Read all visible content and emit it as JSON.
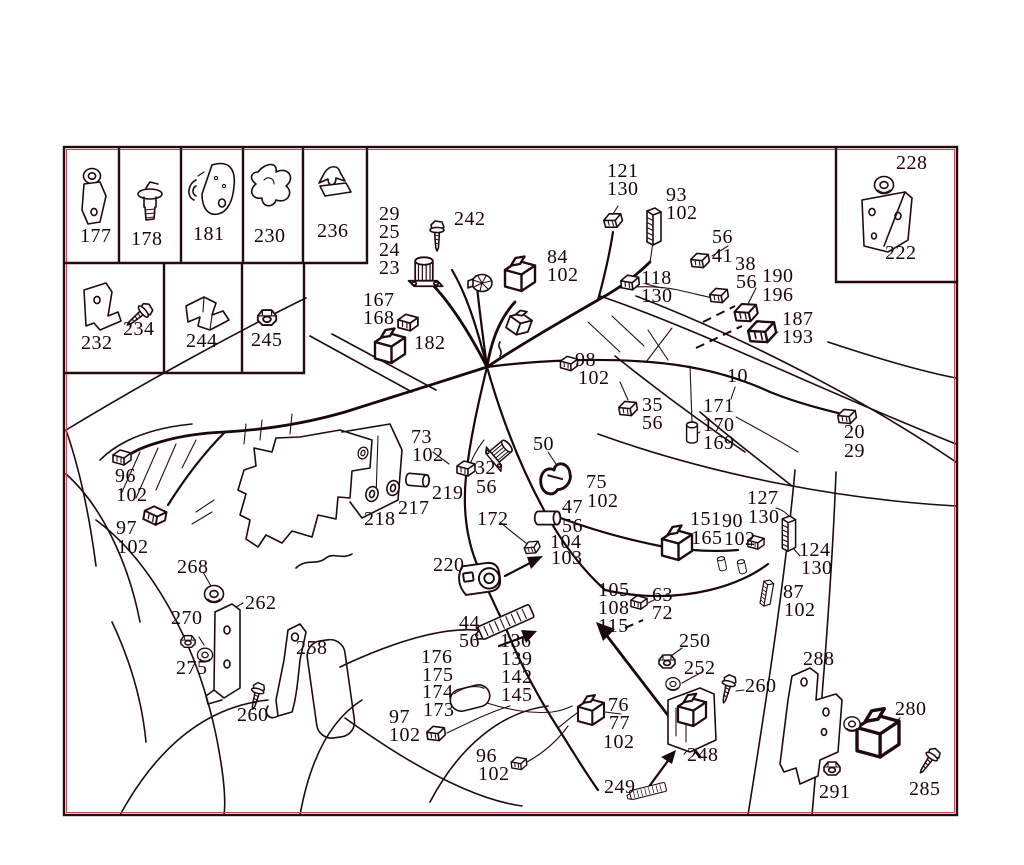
{
  "title": "engine wiring harness parts diagram",
  "colors": {
    "background": "#ffffff",
    "ink": "#200a0e",
    "accent_fringe": "#d24055",
    "label": "#1c0609"
  },
  "inset_rows": {
    "row1": [
      "177",
      "178",
      "181",
      "230",
      "236"
    ],
    "row2": [
      "232",
      "234",
      "244",
      "245"
    ],
    "top_right": [
      "228",
      "222"
    ]
  },
  "callouts": [
    {
      "t": "177",
      "x": 80,
      "y": 229
    },
    {
      "t": "178",
      "x": 131,
      "y": 232
    },
    {
      "t": "181",
      "x": 193,
      "y": 227
    },
    {
      "t": "230",
      "x": 254,
      "y": 229
    },
    {
      "t": "236",
      "x": 317,
      "y": 224
    },
    {
      "t": "232",
      "x": 81,
      "y": 336
    },
    {
      "t": "234",
      "x": 123,
      "y": 322
    },
    {
      "t": "244",
      "x": 186,
      "y": 334
    },
    {
      "t": "245",
      "x": 251,
      "y": 333
    },
    {
      "t": "228",
      "x": 896,
      "y": 156
    },
    {
      "t": "222",
      "x": 885,
      "y": 246
    },
    {
      "t": "29",
      "x": 379,
      "y": 207
    },
    {
      "t": "25",
      "x": 379,
      "y": 225
    },
    {
      "t": "24",
      "x": 379,
      "y": 243
    },
    {
      "t": "23",
      "x": 379,
      "y": 261
    },
    {
      "t": "242",
      "x": 454,
      "y": 212
    },
    {
      "t": "84",
      "x": 547,
      "y": 250
    },
    {
      "t": "102",
      "x": 547,
      "y": 268
    },
    {
      "t": "167",
      "x": 363,
      "y": 293
    },
    {
      "t": "168",
      "x": 363,
      "y": 311
    },
    {
      "t": "182",
      "x": 414,
      "y": 336
    },
    {
      "t": "98",
      "x": 575,
      "y": 353
    },
    {
      "t": "102",
      "x": 578,
      "y": 371
    },
    {
      "t": "121",
      "x": 607,
      "y": 164
    },
    {
      "t": "130",
      "x": 607,
      "y": 182
    },
    {
      "t": "93",
      "x": 666,
      "y": 188
    },
    {
      "t": "102",
      "x": 666,
      "y": 206
    },
    {
      "t": "56",
      "x": 712,
      "y": 230
    },
    {
      "t": "41",
      "x": 712,
      "y": 249
    },
    {
      "t": "38",
      "x": 735,
      "y": 257
    },
    {
      "t": "56",
      "x": 736,
      "y": 275
    },
    {
      "t": "190",
      "x": 762,
      "y": 269
    },
    {
      "t": "196",
      "x": 762,
      "y": 288
    },
    {
      "t": "187",
      "x": 782,
      "y": 312
    },
    {
      "t": "193",
      "x": 782,
      "y": 330
    },
    {
      "t": "118",
      "x": 641,
      "y": 271
    },
    {
      "t": "130",
      "x": 641,
      "y": 289
    },
    {
      "t": "10",
      "x": 727,
      "y": 369
    },
    {
      "t": "35",
      "x": 642,
      "y": 398
    },
    {
      "t": "56",
      "x": 642,
      "y": 416
    },
    {
      "t": "171",
      "x": 703,
      "y": 399
    },
    {
      "t": "170",
      "x": 703,
      "y": 418
    },
    {
      "t": "169",
      "x": 703,
      "y": 436
    },
    {
      "t": "20",
      "x": 844,
      "y": 425
    },
    {
      "t": "29",
      "x": 844,
      "y": 444
    },
    {
      "t": "96",
      "x": 115,
      "y": 469
    },
    {
      "t": "102",
      "x": 116,
      "y": 488
    },
    {
      "t": "97",
      "x": 116,
      "y": 521
    },
    {
      "t": "102",
      "x": 117,
      "y": 540
    },
    {
      "t": "73",
      "x": 411,
      "y": 430
    },
    {
      "t": "102",
      "x": 412,
      "y": 448
    },
    {
      "t": "32",
      "x": 475,
      "y": 461
    },
    {
      "t": "56",
      "x": 476,
      "y": 480
    },
    {
      "t": "50",
      "x": 533,
      "y": 437
    },
    {
      "t": "219",
      "x": 432,
      "y": 486
    },
    {
      "t": "217",
      "x": 398,
      "y": 501
    },
    {
      "t": "218",
      "x": 364,
      "y": 512
    },
    {
      "t": "75",
      "x": 586,
      "y": 475
    },
    {
      "t": "102",
      "x": 587,
      "y": 494
    },
    {
      "t": "47",
      "x": 562,
      "y": 500
    },
    {
      "t": "56",
      "x": 562,
      "y": 519
    },
    {
      "t": "104",
      "x": 550,
      "y": 535
    },
    {
      "t": "103",
      "x": 551,
      "y": 551
    },
    {
      "t": "172",
      "x": 477,
      "y": 512
    },
    {
      "t": "220",
      "x": 433,
      "y": 558
    },
    {
      "t": "127",
      "x": 747,
      "y": 491
    },
    {
      "t": "130",
      "x": 748,
      "y": 510
    },
    {
      "t": "151",
      "x": 690,
      "y": 512
    },
    {
      "t": "165",
      "x": 691,
      "y": 531
    },
    {
      "t": "90",
      "x": 722,
      "y": 514
    },
    {
      "t": "102",
      "x": 724,
      "y": 532
    },
    {
      "t": "124",
      "x": 799,
      "y": 543
    },
    {
      "t": "130",
      "x": 801,
      "y": 561
    },
    {
      "t": "87",
      "x": 783,
      "y": 585
    },
    {
      "t": "102",
      "x": 784,
      "y": 603
    },
    {
      "t": "63",
      "x": 652,
      "y": 588
    },
    {
      "t": "72",
      "x": 652,
      "y": 606
    },
    {
      "t": "105",
      "x": 598,
      "y": 583
    },
    {
      "t": "108",
      "x": 598,
      "y": 601
    },
    {
      "t": "115",
      "x": 598,
      "y": 619
    },
    {
      "t": "268",
      "x": 177,
      "y": 560
    },
    {
      "t": "262",
      "x": 245,
      "y": 596
    },
    {
      "t": "270",
      "x": 171,
      "y": 611
    },
    {
      "t": "275",
      "x": 176,
      "y": 661
    },
    {
      "t": "258",
      "x": 296,
      "y": 641
    },
    {
      "t": "260",
      "x": 237,
      "y": 708
    },
    {
      "t": "44",
      "x": 459,
      "y": 616
    },
    {
      "t": "56",
      "x": 459,
      "y": 634
    },
    {
      "t": "136",
      "x": 500,
      "y": 634
    },
    {
      "t": "139",
      "x": 501,
      "y": 652
    },
    {
      "t": "142",
      "x": 501,
      "y": 670
    },
    {
      "t": "145",
      "x": 501,
      "y": 688
    },
    {
      "t": "176",
      "x": 421,
      "y": 650
    },
    {
      "t": "175",
      "x": 422,
      "y": 668
    },
    {
      "t": "174",
      "x": 422,
      "y": 685
    },
    {
      "t": "173",
      "x": 423,
      "y": 703
    },
    {
      "t": "97",
      "x": 389,
      "y": 710
    },
    {
      "t": "102",
      "x": 389,
      "y": 728
    },
    {
      "t": "96",
      "x": 476,
      "y": 749
    },
    {
      "t": "102",
      "x": 478,
      "y": 767
    },
    {
      "t": "76",
      "x": 608,
      "y": 698
    },
    {
      "t": "77",
      "x": 609,
      "y": 716
    },
    {
      "t": "102",
      "x": 603,
      "y": 735
    },
    {
      "t": "249",
      "x": 604,
      "y": 780
    },
    {
      "t": "248",
      "x": 687,
      "y": 748
    },
    {
      "t": "250",
      "x": 679,
      "y": 634
    },
    {
      "t": "252",
      "x": 684,
      "y": 661
    },
    {
      "t": "260",
      "x": 745,
      "y": 679
    },
    {
      "t": "288",
      "x": 803,
      "y": 652
    },
    {
      "t": "280",
      "x": 895,
      "y": 702
    },
    {
      "t": "291",
      "x": 819,
      "y": 785
    },
    {
      "t": "285",
      "x": 909,
      "y": 782
    }
  ],
  "parts": [
    {
      "n": "connector-121",
      "s": "conn",
      "x": 613,
      "y": 220,
      "r": -15
    },
    {
      "n": "connector-block-93",
      "s": "tall",
      "x": 653,
      "y": 228,
      "r": 0
    },
    {
      "n": "connector-56-41",
      "s": "conn",
      "x": 700,
      "y": 260,
      "r": -10
    },
    {
      "n": "connector-118-130",
      "s": "conn",
      "x": 630,
      "y": 282,
      "r": -5
    },
    {
      "n": "connector-38-56",
      "s": "conn",
      "x": 719,
      "y": 295,
      "r": -10
    },
    {
      "n": "connector-190-196",
      "s": "conn",
      "x": 746,
      "y": 312,
      "r": -12,
      "sc": 1.25
    },
    {
      "n": "connector-187-193",
      "s": "conn",
      "x": 762,
      "y": 331,
      "r": -12,
      "sc": 1.5
    },
    {
      "n": "relay-84",
      "s": "relay",
      "x": 520,
      "y": 276,
      "sc": 1.5
    },
    {
      "n": "canister-29-23",
      "s": "can",
      "x": 424,
      "y": 272,
      "sc": 1.1
    },
    {
      "n": "screw-242",
      "s": "screw",
      "x": 437,
      "y": 237
    },
    {
      "n": "fan-disc",
      "s": "fan",
      "x": 482,
      "y": 283
    },
    {
      "n": "connector-167-168",
      "s": "conn",
      "x": 408,
      "y": 322,
      "sc": 1.1
    },
    {
      "n": "relay-182",
      "s": "relay",
      "x": 390,
      "y": 348,
      "sc": 1.5
    },
    {
      "n": "sensor-hub",
      "s": "relay",
      "x": 519,
      "y": 324,
      "r": 20,
      "sc": 1.1
    },
    {
      "n": "connector-98",
      "s": "conn",
      "x": 569,
      "y": 363,
      "sc": 0.95
    },
    {
      "n": "connector-35-56",
      "s": "conn",
      "x": 628,
      "y": 408,
      "r": -10
    },
    {
      "n": "cylinder-171-169",
      "s": "cyl",
      "x": 692,
      "y": 433,
      "sc": 0.9
    },
    {
      "n": "connector-20-29",
      "s": "conn",
      "x": 847,
      "y": 416,
      "r": -10
    },
    {
      "n": "connector-96-102-top",
      "s": "conn",
      "x": 122,
      "y": 457,
      "sc": 1.0
    },
    {
      "n": "connector-97-102-top",
      "s": "conn",
      "x": 155,
      "y": 515,
      "r": 10,
      "sc": 1.2
    },
    {
      "n": "loop-seal",
      "s": "ring",
      "x": 363,
      "y": 453,
      "r": 20,
      "sc": 0.8
    },
    {
      "n": "seal-218",
      "s": "ring",
      "x": 372,
      "y": 494,
      "r": 15
    },
    {
      "n": "seal-217",
      "s": "ring",
      "x": 393,
      "y": 488,
      "r": 15
    },
    {
      "n": "sleeve-219",
      "s": "cyl",
      "x": 417,
      "y": 480,
      "r": 95
    },
    {
      "n": "connector-32-56",
      "s": "conn",
      "x": 466,
      "y": 468
    },
    {
      "n": "clip-50",
      "s": "clip",
      "x": 556,
      "y": 477,
      "r": -15,
      "sc": 1.8
    },
    {
      "n": "boot-73",
      "s": "can",
      "x": 500,
      "y": 452,
      "r": 50,
      "sc": 0.9
    },
    {
      "n": "sleeve-47-56",
      "s": "cyl",
      "x": 547,
      "y": 518,
      "r": 90,
      "sc": 1.1
    },
    {
      "n": "plug-104-103",
      "s": "conn",
      "x": 532,
      "y": 547,
      "r": -20,
      "sc": 0.85
    },
    {
      "n": "housing-220",
      "s": "barrel",
      "x": 483,
      "y": 578,
      "r": -8,
      "sc": 1.2
    },
    {
      "n": "strip-connector-136",
      "s": "ribbon",
      "x": 506,
      "y": 622,
      "r": -24
    },
    {
      "n": "connector-105",
      "s": "conn",
      "x": 639,
      "y": 602,
      "sc": 0.9
    },
    {
      "n": "relay-151-165",
      "s": "relay",
      "x": 677,
      "y": 545,
      "sc": 1.5
    },
    {
      "n": "pin-a",
      "s": "cyl",
      "x": 722,
      "y": 564,
      "r": -12,
      "sc": 0.6
    },
    {
      "n": "pin-b",
      "s": "cyl",
      "x": 742,
      "y": 567,
      "r": -12,
      "sc": 0.6
    },
    {
      "n": "connector-90-102",
      "s": "conn",
      "x": 756,
      "y": 542,
      "sc": 0.9
    },
    {
      "n": "connector-block-127",
      "s": "tall",
      "x": 788,
      "y": 535,
      "sc": 0.95
    },
    {
      "n": "connector-87-102",
      "s": "tall",
      "x": 766,
      "y": 594,
      "r": 10,
      "sc": 0.72
    },
    {
      "n": "pod-176-173",
      "s": "pod",
      "x": 470,
      "y": 698,
      "r": -14
    },
    {
      "n": "connector-97-102-bottom",
      "s": "conn",
      "x": 436,
      "y": 733,
      "r": -8
    },
    {
      "n": "connector-96-102-bottom",
      "s": "conn",
      "x": 519,
      "y": 763,
      "r": -5,
      "sc": 0.85
    },
    {
      "n": "relay-76-77",
      "s": "relay",
      "x": 591,
      "y": 712,
      "sc": 1.3
    },
    {
      "n": "strip-connector-249",
      "s": "ribbon",
      "x": 648,
      "y": 791,
      "r": -14,
      "sc": 0.65
    },
    {
      "n": "relay-248",
      "s": "relay",
      "x": 692,
      "y": 712,
      "sc": 1.4
    },
    {
      "n": "nut-250",
      "s": "nut",
      "x": 667,
      "y": 661
    },
    {
      "n": "grommet-252",
      "s": "grommet",
      "x": 673,
      "y": 684,
      "sc": 0.75
    },
    {
      "n": "screw-260-right",
      "s": "screw",
      "x": 727,
      "y": 690,
      "r": 15,
      "sc": 0.95
    },
    {
      "n": "motor-280",
      "s": "relay",
      "x": 878,
      "y": 736,
      "r": 0,
      "sc": 2.1
    },
    {
      "n": "grommet-280",
      "s": "grommet",
      "x": 852,
      "y": 724,
      "sc": 0.85
    },
    {
      "n": "nut-291",
      "s": "nut",
      "x": 832,
      "y": 768
    },
    {
      "n": "screw-285",
      "s": "screw",
      "x": 928,
      "y": 762,
      "r": 35,
      "sc": 0.95
    },
    {
      "n": "grommet-268",
      "s": "grommet",
      "x": 214,
      "y": 594
    },
    {
      "n": "nut-270",
      "s": "nut",
      "x": 188,
      "y": 641,
      "sc": 0.9
    },
    {
      "n": "grommet-275",
      "s": "grommet",
      "x": 205,
      "y": 655,
      "sc": 0.8
    },
    {
      "n": "screw-260-left",
      "s": "screw",
      "x": 256,
      "y": 697,
      "r": 15,
      "sc": 0.9
    },
    {
      "n": "bolt-234",
      "s": "screw",
      "x": 138,
      "y": 316,
      "r": 50,
      "sc": 1.0
    },
    {
      "n": "nut-245",
      "s": "nut",
      "x": 267,
      "y": 317,
      "sc": 1.15
    },
    {
      "n": "grommet-228",
      "s": "grommet",
      "x": 884,
      "y": 185,
      "sc": 1.0
    }
  ]
}
